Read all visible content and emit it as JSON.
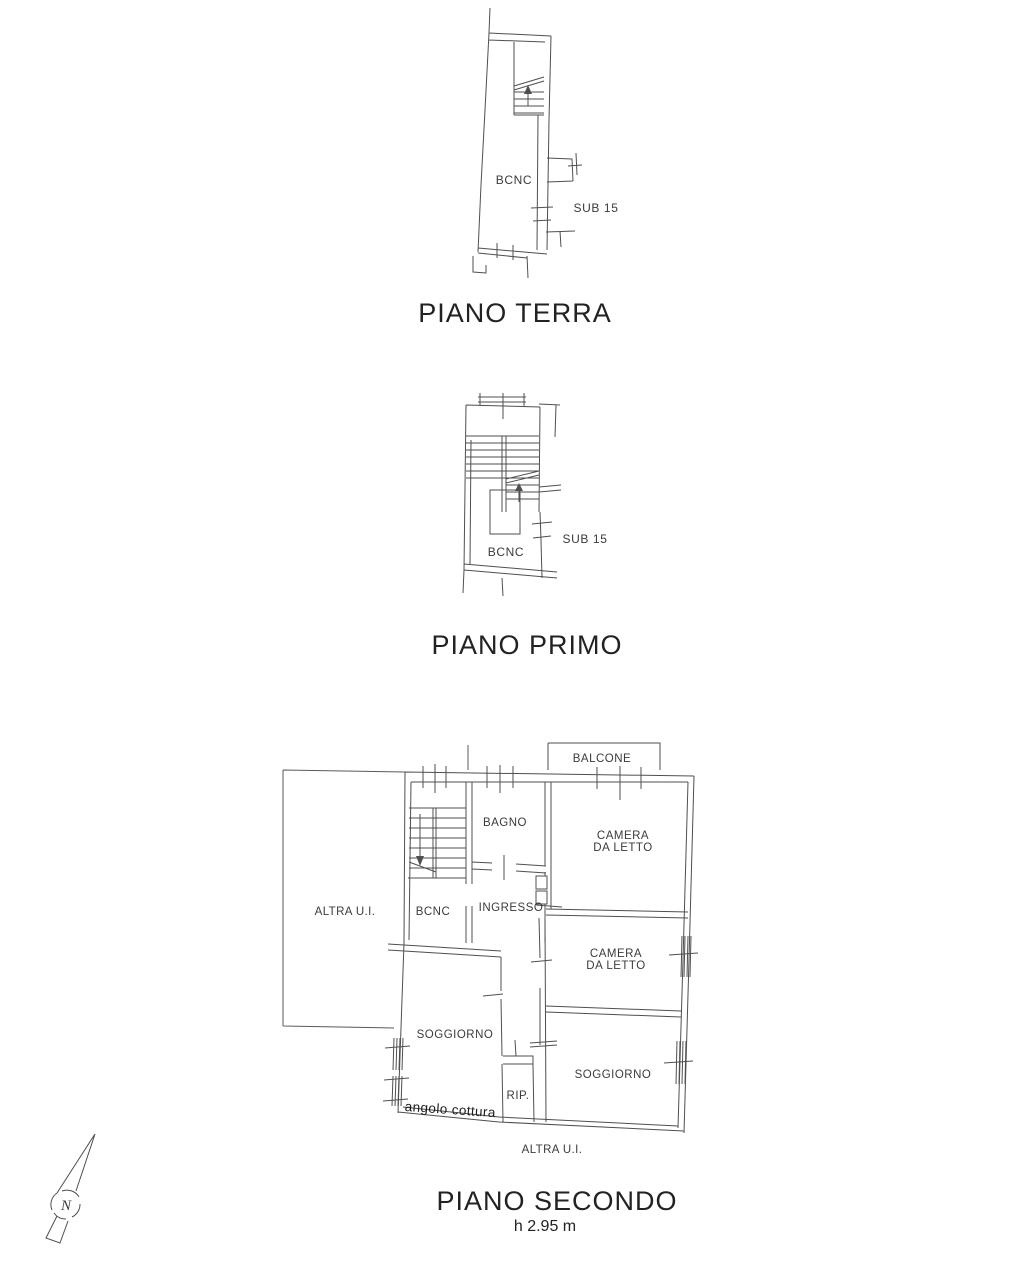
{
  "colors": {
    "line": "#4f4f4f",
    "text": "#3b3b3b",
    "background": "#ffffff"
  },
  "floors": {
    "terra": {
      "title": "PIANO TERRA",
      "bcnc": "BCNC",
      "sub": "SUB 15"
    },
    "primo": {
      "title": "PIANO PRIMO",
      "bcnc": "BCNC",
      "sub": "SUB 15"
    },
    "secondo": {
      "title": "PIANO SECONDO",
      "height_note": "h 2.95 m",
      "balcone": "BALCONE",
      "bagno": "BAGNO",
      "camera1": {
        "line1": "CAMERA",
        "line2": "DA LETTO"
      },
      "camera2": {
        "line1": "CAMERA",
        "line2": "DA LETTO"
      },
      "ingresso": "INGRESSO",
      "bcnc": "BCNC",
      "altra_ui_left": "ALTRA U.I.",
      "altra_ui_bottom": "ALTRA U.I.",
      "soggiorno_left": "SOGGIORNO",
      "soggiorno_right": "SOGGIORNO",
      "rip": "RIP.",
      "angolo_cottura": "angolo cottura"
    }
  },
  "compass": {
    "north": "N"
  }
}
